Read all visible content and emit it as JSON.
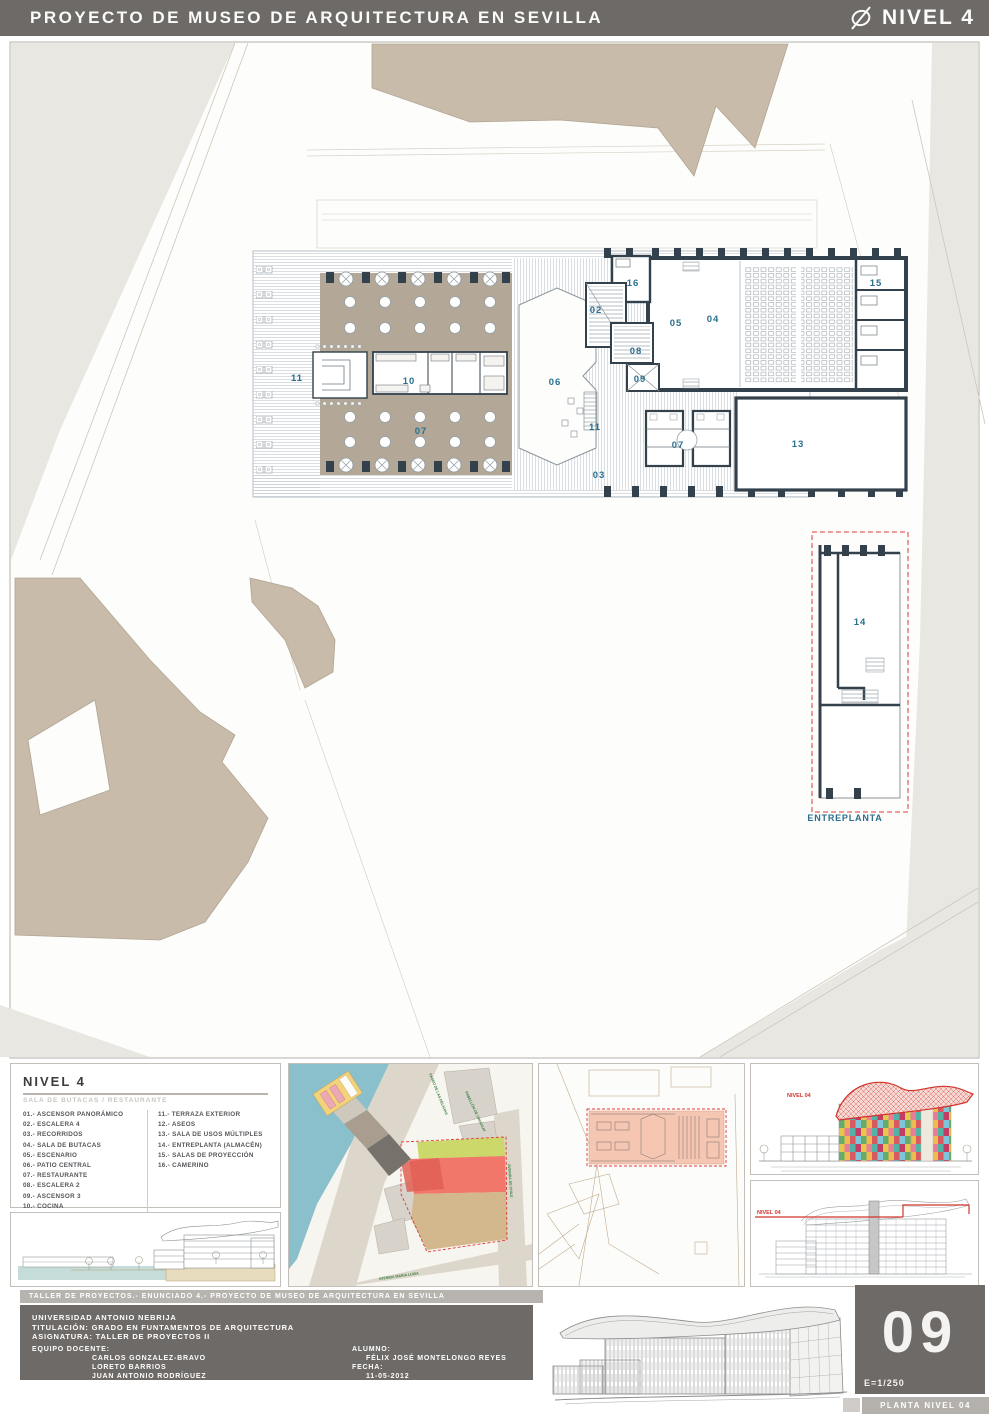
{
  "header": {
    "title": "PROYECTO DE MUSEO DE ARQUITECTURA EN SEVILLA",
    "level": "NIVEL 4"
  },
  "plan": {
    "room_labels": [
      "11",
      "10",
      "07",
      "06",
      "02",
      "05",
      "04",
      "16",
      "15",
      "08",
      "09",
      "11",
      "07",
      "13",
      "03"
    ],
    "mezzanine_label": "14",
    "mezzanine_title": "ENTREPLANTA"
  },
  "legend": {
    "title": "NIVEL 4",
    "subtitle": "SALA DE BUTACAS / RESTAURANTE",
    "col1": [
      "01.- ASCENSOR PANORÁMICO",
      "02.- ESCALERA 4",
      "03.- RECORRIDOS",
      "04.- SALA DE BUTACAS",
      "05.- ESCENARIO",
      "06.- PATIO CENTRAL",
      "07.- RESTAURANTE",
      "08.- ESCALERA 2",
      "09.- ASCENSOR 3",
      "10.- COCINA"
    ],
    "col2": [
      "11.- TERRAZA EXTERIOR",
      "12.- ASEOS",
      "13.- SALA DE USOS MÚLTIPLES",
      "14.- ENTREPLANTA (ALMACÉN)",
      "15.- SALAS DE PROYECCIÓN",
      "16.- CAMERINO"
    ]
  },
  "site_panel": {
    "street_top": "PASEO DE LAS DELICIAS",
    "street_bottom": "AVENIDA MARIA LUISA",
    "street_right": "AVENIDA DE CHILE",
    "building_label": "PABELLÓN DE URUGUAY"
  },
  "elevation_panel": {
    "level_tag": "NIVEL 04"
  },
  "section_panel": {
    "level_tag": "NIVEL 04"
  },
  "footer": {
    "strip": "TALLER DE PROYECTOS.- ENUNCIADO 4.- PROYECTO DE MUSEO DE ARQUITECTURA EN SEVILLA",
    "university": "UNIVERSIDAD ANTONIO NEBRIJA",
    "titulacion": "TITULACIÓN: GRADO EN FUNTAMENTOS DE ARQUITECTURA",
    "asignatura": "ASIGNATURA: TALLER DE PROYECTOS II",
    "equipo_label": "EQUIPO DOCENTE:",
    "equipo": [
      "CARLOS GONZALEZ-BRAVO",
      "LORETO BARRIOS",
      "JUAN ANTONIO RODRÍGUEZ"
    ],
    "alumno_label": "ALUMNO:",
    "alumno": "FÉLIX JOSÉ MONTELONGO REYES",
    "fecha_label": "FECHA:",
    "fecha": "11-05-2012",
    "sheet_number": "09",
    "scale": "E=1/250",
    "sheet_title": "PLANTA NIVEL 04"
  },
  "colors": {
    "header_bg": "#6e6a67",
    "label_blue": "#2a6f8e",
    "highlight_red": "#e03a38",
    "building_beige": "#c8bbaa",
    "restaurant_taupe": "#b3a897",
    "wall_dark": "#32414b",
    "water_blue": "#8abfcc",
    "zone_green": "#ccd96a",
    "zone_red": "#f2776b",
    "zone_tan": "#d2b88c",
    "site_salmon": "#f5c6b2"
  }
}
